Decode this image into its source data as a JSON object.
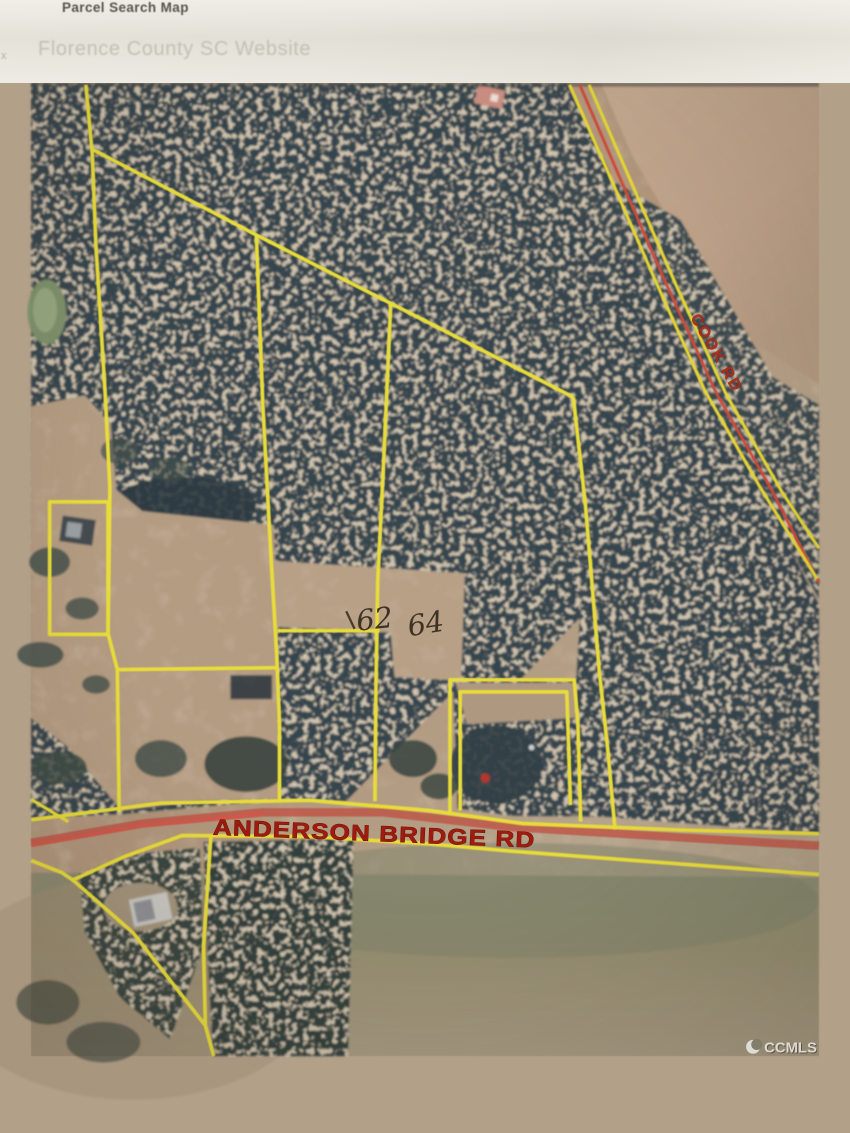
{
  "header": {
    "title": "Parcel Search Map",
    "subtitle": "Florence County SC Website",
    "edge_fragment": "x"
  },
  "map": {
    "roads": [
      {
        "id": "cook-rd",
        "label": "COOK RD"
      },
      {
        "id": "anderson-bridge-rd",
        "label": "ANDERSON BRIDGE RD"
      }
    ],
    "annotations": [
      {
        "text": "62"
      },
      {
        "text": "64"
      }
    ],
    "watermark": {
      "text": "CCMLS"
    },
    "colors": {
      "parcel_line": "#e8dc3a",
      "road_center_red": "#cf4a3a",
      "road_label_red": "#9e1b0e",
      "forest_dark": "#36444d",
      "field_tan": "#b29a80",
      "field_green": "#8f8d72",
      "header_bg": "#eae7de",
      "watermark_white": "#faf9f5"
    }
  }
}
